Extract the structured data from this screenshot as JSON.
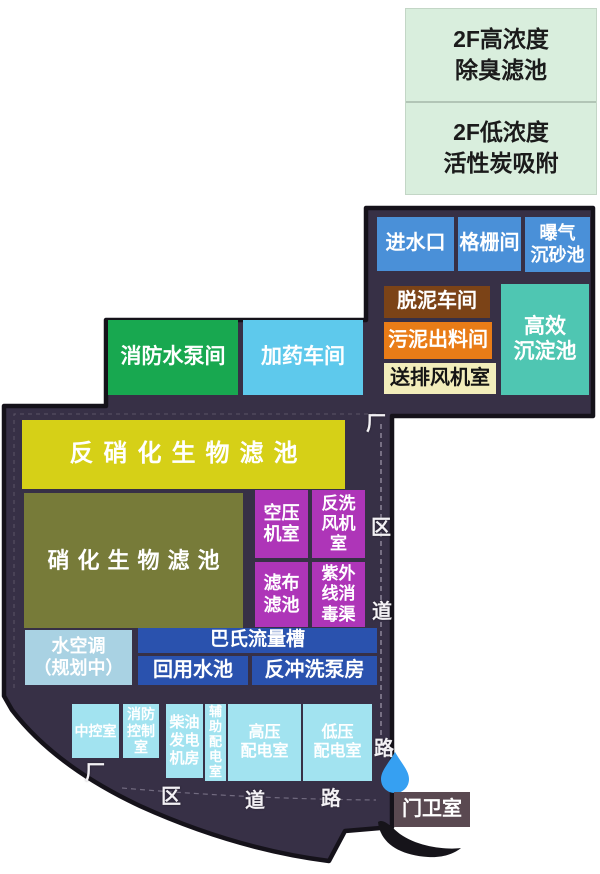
{
  "legend": {
    "items": [
      {
        "id": "high",
        "label": "2F高浓度\n除臭滤池"
      },
      {
        "id": "low",
        "label": "2F低浓度\n活性炭吸附"
      }
    ]
  },
  "zones": {
    "water_inlet": {
      "label": "进水口"
    },
    "screen_room": {
      "label": "格栅间"
    },
    "aerated_grit_chamber": {
      "label": "曝气\n沉砂池"
    },
    "sludge_dewatering": {
      "label": "脱泥车间"
    },
    "sludge_discharge": {
      "label": "污泥出料间"
    },
    "supply_exhaust_fan_room": {
      "label": "送排风机室"
    },
    "high_efficiency_sedimentation": {
      "label": "高效\n沉淀池"
    },
    "fire_pump_room": {
      "label": "消防水泵间"
    },
    "dosing_workshop": {
      "label": "加药车间"
    },
    "denitrification_biofilter": {
      "label": "反硝化生物滤池"
    },
    "nitrification_biofilter": {
      "label": "硝化生物滤池"
    },
    "air_compressor_room": {
      "label": "空压\n机室"
    },
    "backwash_fan_room": {
      "label": "反洗\n风机\n室"
    },
    "cloth_filter": {
      "label": "滤布\n滤池"
    },
    "uv_disinfection_channel": {
      "label": "紫外\n线消\n毒渠"
    },
    "water_ac_planned": {
      "label": "水空调\n（规划中）"
    },
    "parshall_flume": {
      "label": "巴氏流量槽"
    },
    "reuse_water_pool": {
      "label": "回用水池"
    },
    "backwash_pump_house": {
      "label": "反冲洗泵房"
    },
    "central_control_room": {
      "label": "中控室"
    },
    "fire_control_room": {
      "label": "消防\n控制\n室"
    },
    "diesel_generator_room": {
      "label": "柴油\n发电\n机房"
    },
    "auxiliary_power_room": {
      "label": "辅\n助\n配\n电\n室"
    },
    "hv_power_room": {
      "label": "高压\n配电室"
    },
    "lv_power_room": {
      "label": "低压\n配电室"
    },
    "guard_room": {
      "label": "门卫室"
    }
  },
  "roads": {
    "right_vertical": [
      "厂",
      "区",
      "道",
      "路"
    ],
    "bottom_horizontal": [
      "厂",
      "区",
      "道",
      "路"
    ]
  },
  "icons": {
    "water_drop": "water-drop-marker"
  },
  "colors": {
    "site_ground": "#373046",
    "site_border": "#15121a",
    "legend_bg": "#d9eedd",
    "inlet_blue": "#4a90d8",
    "sludge_brown": "#7b4317",
    "discharge_orange": "#e97c17",
    "fan_cream": "#f2edbb",
    "sedimentation_teal": "#4fc6b2",
    "fire_green": "#18a850",
    "dosing_cyan": "#5ec9ec",
    "denitrification_yellow": "#d6d017",
    "nitrification_olive": "#777b39",
    "magenta": "#ae35b8",
    "planned_lightblue": "#a9d2e3",
    "pool_blue": "#2a52ae",
    "power_cyan": "#a2e3f0",
    "guard_mauve": "#5a4951",
    "drop_blue": "#36a0f2"
  }
}
